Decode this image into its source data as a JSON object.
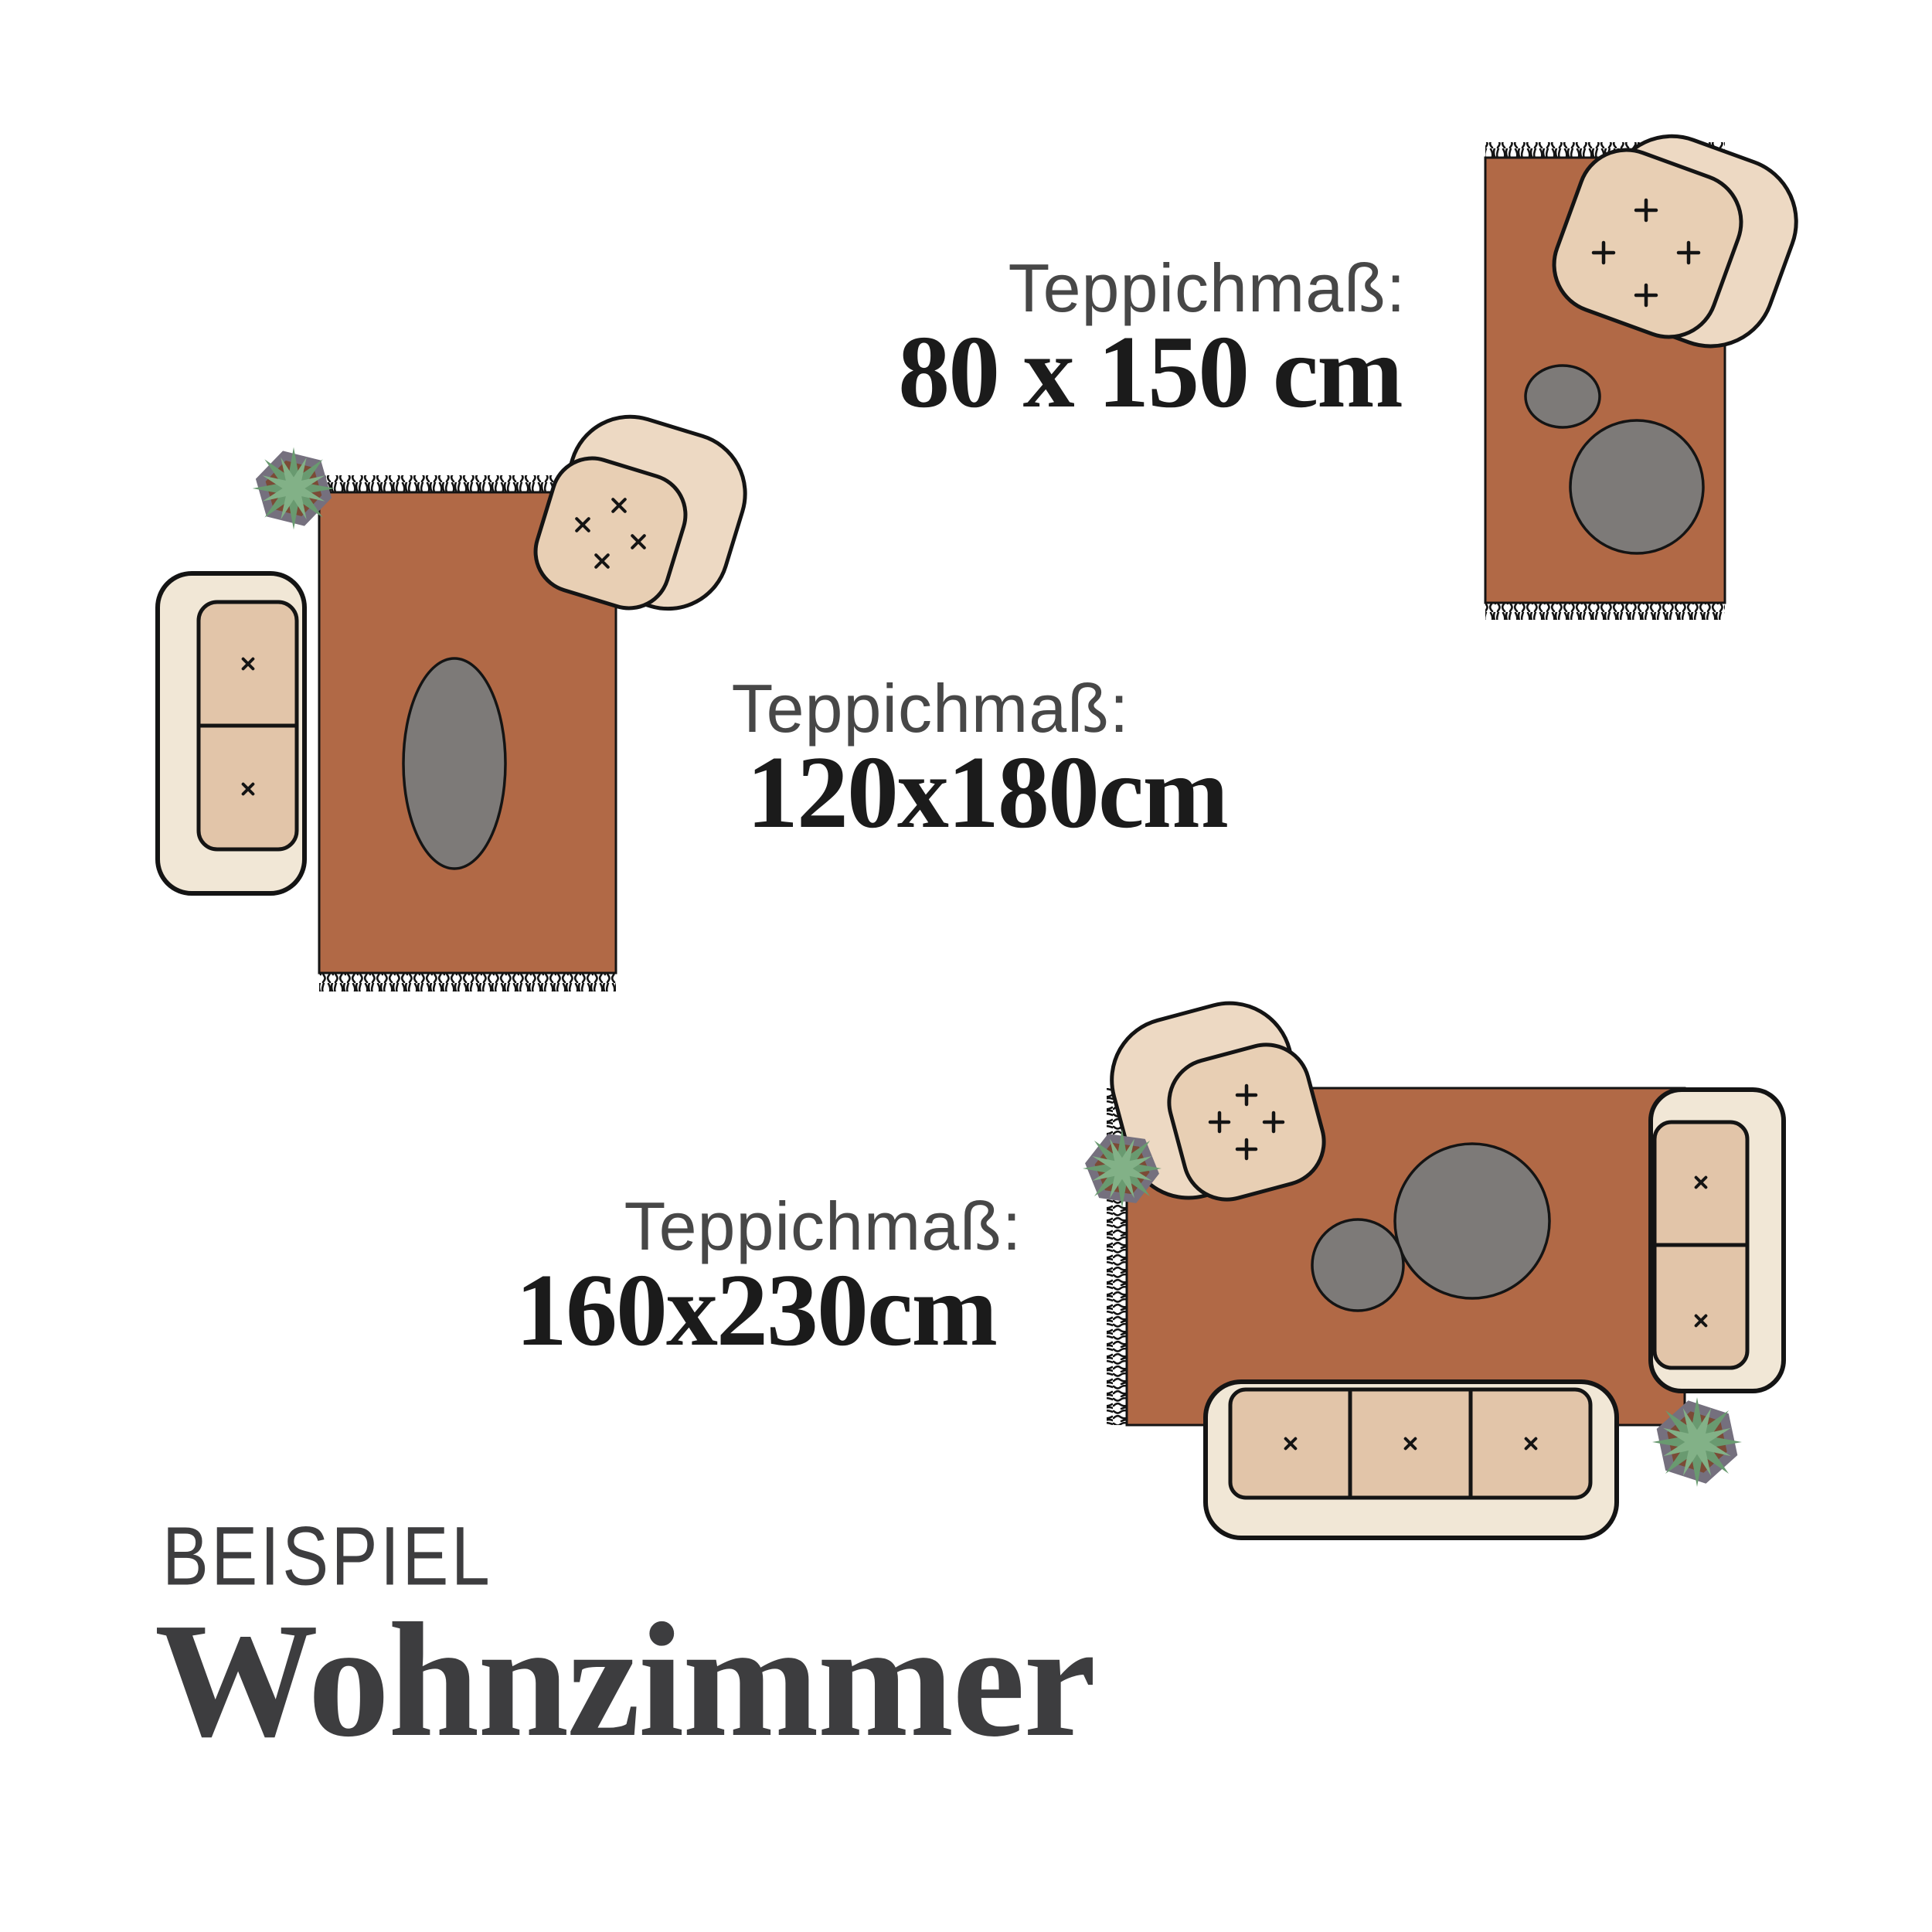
{
  "page": {
    "background": "#ffffff",
    "kind": "rug size example infographic"
  },
  "colors": {
    "rug": "#b16946",
    "table": "#7d7a78",
    "shell": "#f1e7d6",
    "cushion": "#e2c5a9",
    "chair_back": "#edd9c3",
    "chair_seat": "#e8cfb4",
    "leaf": "#82b187",
    "leaf_dark": "#699a70",
    "pot": "#75707e",
    "soil": "#7b4b36",
    "outline": "#141414",
    "text_label": "#474747",
    "text_size": "#1b1b1b",
    "text_footer": "#3d3d3f"
  },
  "labels": [
    {
      "title": "Teppichmaß:",
      "size": "80 x 150 cm"
    },
    {
      "title": "Teppichmaß:",
      "size": "120x180cm"
    },
    {
      "title": "Teppichmaß:",
      "size": "160x230cm"
    }
  ],
  "footer": {
    "eyebrow": "BEISPIEL",
    "title": "Wohnzimmer"
  }
}
